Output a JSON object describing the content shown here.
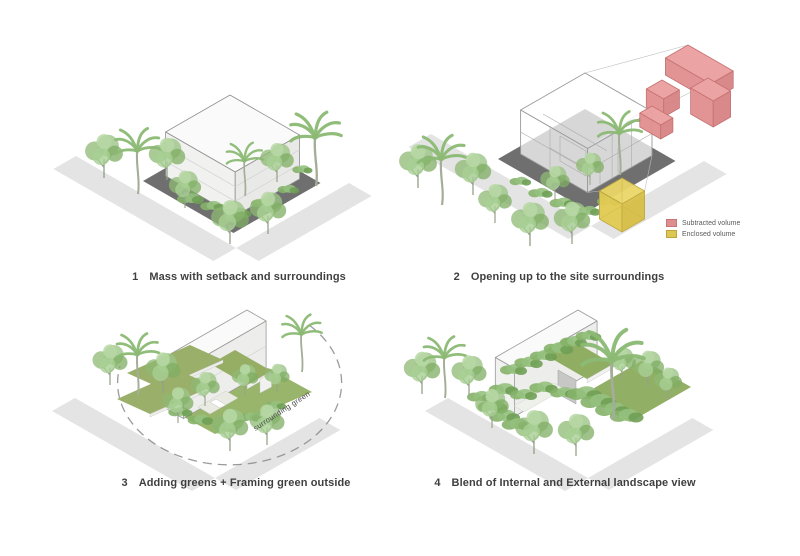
{
  "sheet": {
    "background": "#ffffff"
  },
  "figures": [
    {
      "number": "1",
      "label": "Mass with setback and surroundings"
    },
    {
      "number": "2",
      "label": "Opening up to the site surroundings"
    },
    {
      "number": "3",
      "label": "Adding greens + Framing green outside"
    },
    {
      "number": "4",
      "label": "Blend of Internal and External landscape view"
    }
  ],
  "legend": {
    "items": [
      {
        "label": "Subtracted volume",
        "color": "#dd8f8f",
        "border": "#c67676"
      },
      {
        "label": "Enclosed volume",
        "color": "#ddc753",
        "border": "#bda53b"
      }
    ]
  },
  "annotations": {
    "surrounding_green": "surrounding green"
  },
  "palette": {
    "tree_green": "#8fbc77",
    "terrace_green": "#96ad64",
    "ground_green": "#93b163",
    "site_plane_gray": "#6f6f6f",
    "road_gray": "#e4e4e4",
    "building_white": "#f4f4f2",
    "subtracted_red": "#dd8f8f",
    "enclosed_yellow": "#ddc753"
  }
}
